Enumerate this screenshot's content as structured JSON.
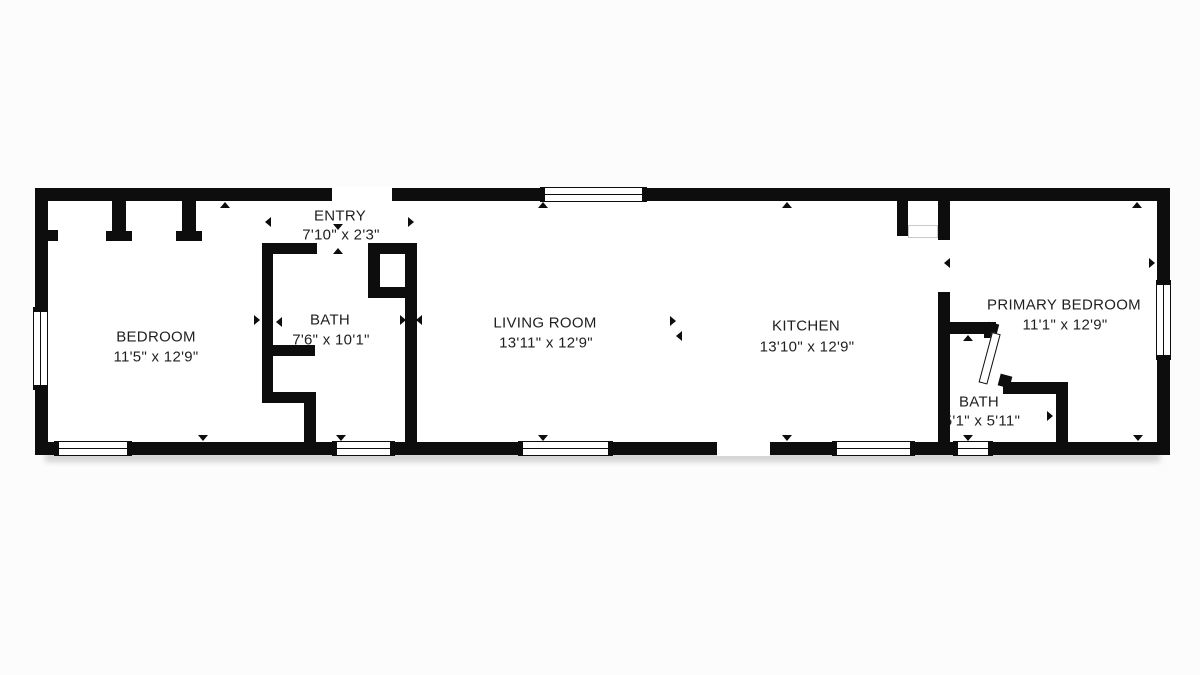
{
  "page": {
    "background": "#fcfcfc",
    "wall_color": "#0d0d0d",
    "text_color": "#1f1f21"
  },
  "rooms": [
    {
      "name": "BEDROOM",
      "dimensions": "11'5\" x 12'9\"",
      "x": 156,
      "y": 337
    },
    {
      "name": "ENTRY",
      "dimensions": "7'10\" x 2'3\"",
      "x": 340,
      "y": 216,
      "dx": 341,
      "dy": 235
    },
    {
      "name": "BATH",
      "dimensions": "7'6\" x 10'1\"",
      "x": 330,
      "y": 320,
      "dx": 331,
      "dy": 340
    },
    {
      "name": "LIVING ROOM",
      "dimensions": "13'11\" x 12'9\"",
      "x": 545,
      "y": 323,
      "dx": 546,
      "dy": 343
    },
    {
      "name": "KITCHEN",
      "dimensions": "13'10\" x 12'9\"",
      "x": 806,
      "y": 326,
      "dx": 807,
      "dy": 347
    },
    {
      "name": "PRIMARY BEDROOM",
      "dimensions": "11'1\" x 12'9\"",
      "x": 1064,
      "y": 305,
      "dx": 1065,
      "dy": 325
    },
    {
      "name": "BATH",
      "dimensions": "5'1\" x 5'11\"",
      "x": 979,
      "y": 402,
      "dx": 982,
      "dy": 421
    }
  ],
  "plan": {
    "floor": {
      "x": 35,
      "y": 188,
      "w": 1135,
      "h": 267
    },
    "shadow": {
      "x": 45,
      "y": 452,
      "w": 1115,
      "h": 10
    },
    "walls": [
      {
        "x": 35,
        "y": 188,
        "w": 1135,
        "h": 13,
        "part": "exterior-top"
      },
      {
        "x": 35,
        "y": 442,
        "w": 1135,
        "h": 13,
        "part": "exterior-bottom"
      },
      {
        "x": 35,
        "y": 188,
        "w": 13,
        "h": 267,
        "part": "exterior-left"
      },
      {
        "x": 1157,
        "y": 188,
        "w": 13,
        "h": 267,
        "part": "exterior-right"
      },
      {
        "x": 112,
        "y": 201,
        "w": 14,
        "h": 31,
        "part": "bedroom-closet-divider-1"
      },
      {
        "x": 106,
        "y": 231,
        "w": 26,
        "h": 10,
        "part": "bedroom-closet-foot-1"
      },
      {
        "x": 182,
        "y": 201,
        "w": 14,
        "h": 31,
        "part": "bedroom-closet-divider-2"
      },
      {
        "x": 176,
        "y": 231,
        "w": 26,
        "h": 10,
        "part": "bedroom-closet-foot-2"
      },
      {
        "x": 48,
        "y": 230,
        "w": 10,
        "h": 11,
        "part": "bedroom-closet-left-stub"
      },
      {
        "x": 262,
        "y": 243,
        "w": 55,
        "h": 11,
        "part": "entry-bottom-wall"
      },
      {
        "x": 262,
        "y": 243,
        "w": 11,
        "h": 160,
        "part": "bedroom-bath-wall"
      },
      {
        "x": 262,
        "y": 345,
        "w": 53,
        "h": 11,
        "part": "bath-niche-top"
      },
      {
        "x": 262,
        "y": 392,
        "w": 53,
        "h": 11,
        "part": "bath-niche-bottom"
      },
      {
        "x": 304,
        "y": 392,
        "w": 12,
        "h": 50,
        "part": "bath-jog-wall"
      },
      {
        "x": 368,
        "y": 243,
        "w": 49,
        "h": 11,
        "part": "bath-closet-top"
      },
      {
        "x": 368,
        "y": 243,
        "w": 12,
        "h": 55,
        "part": "bath-closet-left"
      },
      {
        "x": 368,
        "y": 287,
        "w": 49,
        "h": 11,
        "part": "bath-closet-bottom"
      },
      {
        "x": 405,
        "y": 243,
        "w": 12,
        "h": 199,
        "part": "bath-living-wall"
      },
      {
        "x": 897,
        "y": 201,
        "w": 11,
        "h": 35,
        "part": "kitchen-closet-wall"
      },
      {
        "x": 938,
        "y": 201,
        "w": 12,
        "h": 39,
        "part": "kitchen-primary-wall-upper"
      },
      {
        "x": 938,
        "y": 292,
        "w": 12,
        "h": 150,
        "part": "kitchen-primary-wall-lower"
      },
      {
        "x": 938,
        "y": 322,
        "w": 58,
        "h": 12,
        "part": "bath2-top-wall"
      },
      {
        "x": 984,
        "y": 322,
        "w": 12,
        "h": 16,
        "part": "bath2-door-jamb"
      },
      {
        "x": 1003,
        "y": 382,
        "w": 65,
        "h": 12,
        "part": "bath2-bottom-wall"
      },
      {
        "x": 1056,
        "y": 382,
        "w": 12,
        "h": 60,
        "part": "bath2-right-wall"
      }
    ],
    "gaps": [
      {
        "x": 332,
        "y": 187,
        "w": 60,
        "h": 15,
        "part": "front-entry-door-opening"
      },
      {
        "x": 717,
        "y": 441,
        "w": 53,
        "h": 15,
        "part": "rear-door-opening"
      }
    ],
    "windows": [
      {
        "o": "h",
        "x": 540,
        "y": 187,
        "w": 107,
        "h": 15
      },
      {
        "o": "h",
        "x": 54,
        "y": 441,
        "w": 78,
        "h": 15
      },
      {
        "o": "h",
        "x": 332,
        "y": 441,
        "w": 63,
        "h": 15
      },
      {
        "o": "h",
        "x": 518,
        "y": 441,
        "w": 95,
        "h": 15
      },
      {
        "o": "h",
        "x": 832,
        "y": 441,
        "w": 83,
        "h": 15
      },
      {
        "o": "h",
        "x": 953,
        "y": 441,
        "w": 40,
        "h": 15
      },
      {
        "o": "v",
        "x": 33,
        "y": 307,
        "w": 15,
        "h": 83
      },
      {
        "o": "v",
        "x": 1156,
        "y": 280,
        "w": 15,
        "h": 80
      }
    ],
    "door_leaf": {
      "x": 992,
      "y": 332,
      "w": 9,
      "h": 52,
      "rot": 15
    },
    "wedges": [
      {
        "x": 987,
        "y": 323,
        "s": 11,
        "rot": 15
      },
      {
        "x": 999,
        "y": 375,
        "s": 12,
        "rot": 15
      }
    ],
    "closet_doors": {
      "x": 908,
      "y": 225,
      "w": 30,
      "h": 13
    },
    "markers": [
      {
        "dir": "up",
        "x": 225,
        "y": 205
      },
      {
        "dir": "up",
        "x": 543,
        "y": 205
      },
      {
        "dir": "up",
        "x": 787,
        "y": 205
      },
      {
        "dir": "up",
        "x": 1137,
        "y": 205
      },
      {
        "dir": "down",
        "x": 338,
        "y": 227
      },
      {
        "dir": "up",
        "x": 338,
        "y": 251
      },
      {
        "dir": "left",
        "x": 268,
        "y": 222
      },
      {
        "dir": "right",
        "x": 411,
        "y": 222
      },
      {
        "dir": "right",
        "x": 257,
        "y": 320
      },
      {
        "dir": "left",
        "x": 279,
        "y": 322
      },
      {
        "dir": "right",
        "x": 403,
        "y": 320
      },
      {
        "dir": "left",
        "x": 419,
        "y": 320
      },
      {
        "dir": "right",
        "x": 673,
        "y": 321
      },
      {
        "dir": "left",
        "x": 679,
        "y": 336
      },
      {
        "dir": "left",
        "x": 947,
        "y": 263
      },
      {
        "dir": "right",
        "x": 1152,
        "y": 263
      },
      {
        "dir": "up",
        "x": 968,
        "y": 338
      },
      {
        "dir": "right",
        "x": 1050,
        "y": 416
      },
      {
        "dir": "down",
        "x": 203,
        "y": 438
      },
      {
        "dir": "down",
        "x": 341,
        "y": 438
      },
      {
        "dir": "down",
        "x": 543,
        "y": 438
      },
      {
        "dir": "down",
        "x": 787,
        "y": 438
      },
      {
        "dir": "down",
        "x": 968,
        "y": 438
      },
      {
        "dir": "down",
        "x": 1138,
        "y": 438
      }
    ]
  }
}
